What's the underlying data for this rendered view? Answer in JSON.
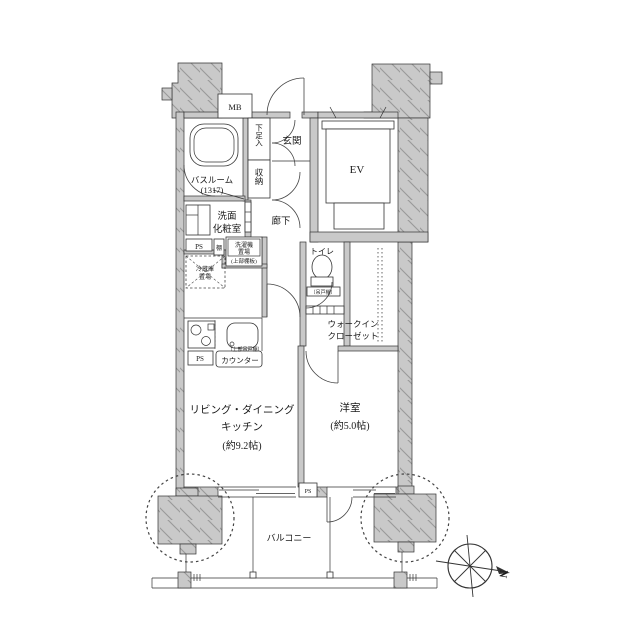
{
  "rooms": {
    "meter_box": "MB",
    "entrance": "玄関",
    "shoe_cabinet": "下足入",
    "bathroom_line1": "バスルーム",
    "bathroom_line2": "(1317)",
    "storage": "収納",
    "elevator": "EV",
    "washroom_line1": "洗面",
    "washroom_line2": "化粧室",
    "hallway": "廊下",
    "toilet": "トイレ",
    "toilet_note": "〔吊戸棚〕",
    "wic_line1": "ウォークイン",
    "wic_line2": "クローゼット",
    "ldk_line1": "リビング・ダイニング",
    "ldk_line2": "キッチン",
    "ldk_size": "(約9.2帖)",
    "western_line1": "洋室",
    "western_size": "(約5.0帖)",
    "balcony": "バルコニー"
  },
  "fixtures": {
    "ps": "PS",
    "shelf": "棚",
    "laundry_line1": "洗濯機",
    "laundry_line2": "置場",
    "laundry_note": "(上部棚板)",
    "fridge_line1": "冷蔵庫",
    "fridge_line2": "置場",
    "counter": "カウンター",
    "counter_note": "〔上部吊戸棚〕"
  },
  "compass": {
    "north": "N"
  },
  "colors": {
    "wall_fill": "#c9c9c9",
    "hatch_line": "#999999",
    "outline": "#333333",
    "text": "#1a1a1a"
  }
}
